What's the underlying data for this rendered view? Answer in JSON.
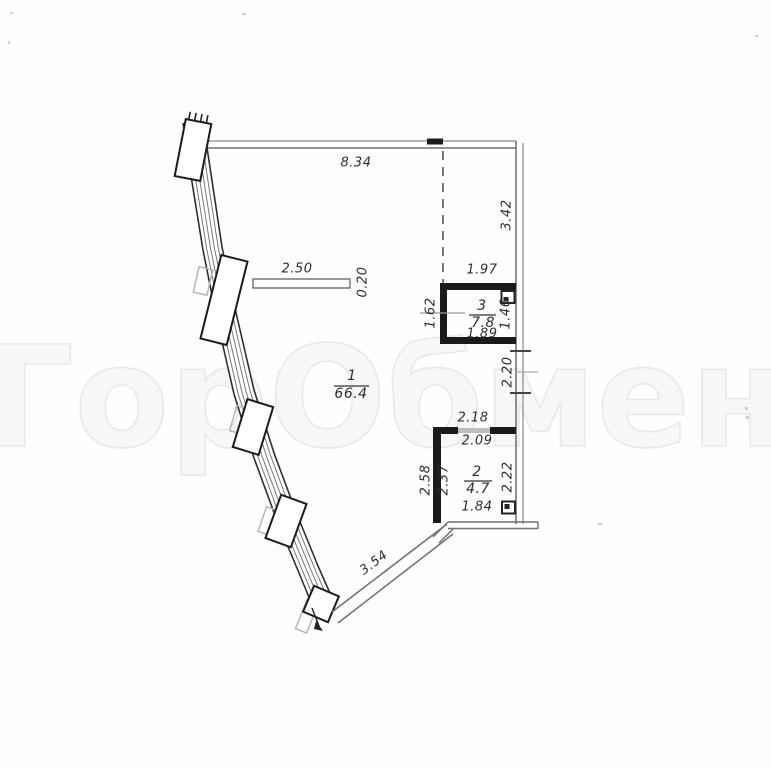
{
  "watermark": {
    "text": "ГорОбмен"
  },
  "plan": {
    "rooms": [
      {
        "number": "1",
        "area": "66.4"
      },
      {
        "number": "2",
        "area": "4.7"
      },
      {
        "number": "3",
        "area": "7.8"
      }
    ],
    "dims": {
      "top_width": "8.34",
      "right_height": "3.42",
      "shelf_width": "2.50",
      "shelf_depth": "0.20",
      "room3_top": "1.97",
      "room3_left": "1.62",
      "room3_right": "1.46",
      "room3_bottom": "1.89",
      "corridor_right": "2.20",
      "room2_door_outer": "2.18",
      "room2_door_inner": "2.09",
      "room2_left_outer": "2.58",
      "room2_left_inner": "2.37",
      "room2_right": "2.22",
      "room2_bottom": "1.84",
      "bottom_diagonal": "3.54"
    }
  }
}
